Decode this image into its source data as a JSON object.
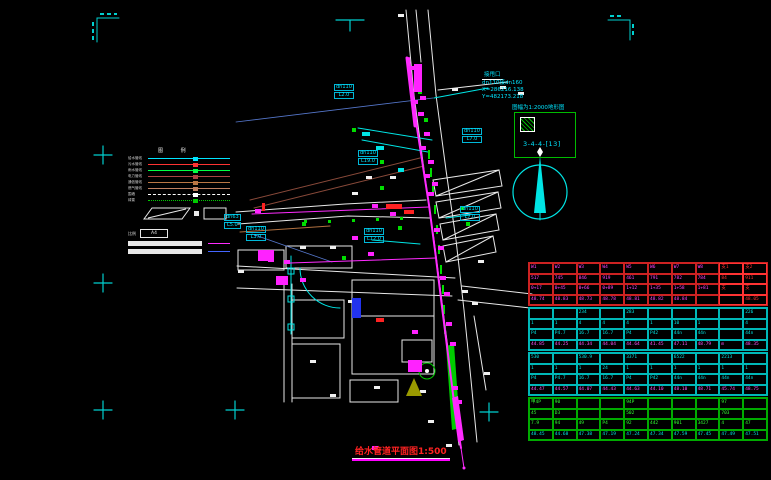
{
  "title": {
    "text": "给水管道平面图",
    "scale": "1:500"
  },
  "callout": {
    "note": "接甩口",
    "spec": "dn110接dn160",
    "coord_x": "X=286216.138",
    "coord_y": "Y=482173.218"
  },
  "detail": {
    "note": "图幅为1:2000地形图",
    "code": "3-4-4-[13]"
  },
  "north_arrow": "north-compass",
  "legend": {
    "header": "图 例",
    "items": [
      {
        "label": "给水管线",
        "color": "#00e5ff",
        "style": "solid"
      },
      {
        "label": "污水管线",
        "color": "#ff3333",
        "style": "solid"
      },
      {
        "label": "雨水管线",
        "color": "#00ff44",
        "style": "solid"
      },
      {
        "label": "电力管线",
        "color": "#aa4444",
        "style": "solid"
      },
      {
        "label": "通信管线",
        "color": "#bb7744",
        "style": "solid"
      },
      {
        "label": "燃气管线",
        "color": "#c08060",
        "style": "solid"
      },
      {
        "label": "围墙",
        "color": "#ffffff",
        "style": "dashed"
      },
      {
        "label": "绿篱",
        "color": "#00cc00",
        "style": "dotted"
      }
    ],
    "scale_label": "比例",
    "box_text": "A4"
  },
  "map": {
    "pipe_labels": [
      {
        "size": "dn110",
        "len": "L2.0",
        "x": 334,
        "y": 84
      },
      {
        "size": "dn110",
        "len": "L19.0",
        "x": 358,
        "y": 150
      },
      {
        "size": "dn110",
        "len": "L7.0",
        "x": 462,
        "y": 128
      },
      {
        "size": "dn110",
        "len": "L7.0",
        "x": 460,
        "y": 206
      },
      {
        "size": "dn63",
        "len": "L5.0",
        "x": 224,
        "y": 214
      },
      {
        "size": "dn110",
        "len": "L3.0",
        "x": 246,
        "y": 226
      },
      {
        "size": "dn110",
        "len": "L12.0",
        "x": 364,
        "y": 228
      }
    ]
  },
  "table": {
    "red_color": "#ff3333",
    "groups": [
      {
        "border": "#cc2222",
        "red_from": 8,
        "rows": [
          {
            "color": "#ff44ff",
            "cells": [
              "W1",
              "W2",
              "W3",
              "W4",
              "W5",
              "W6",
              "W7",
              "W8",
              "支1",
              "支2"
            ]
          },
          {
            "color": "#ff44ff",
            "cells": [
              "517",
              "745",
              "846",
              "919",
              "461",
              "791",
              "782",
              "784",
              "84",
              "911"
            ]
          },
          {
            "color": "#ff44ff",
            "cells": [
              "0+17",
              "0+45",
              "0+66",
              "0+89",
              "1+12",
              "1+35",
              "1+58",
              "1+81",
              "支",
              "支"
            ]
          },
          {
            "color": "#ff44ff",
            "cells": [
              "48.74",
              "48.83",
              "48.73",
              "48.78",
              "48.81",
              "48.82",
              "48.84",
              "",
              "",
              "48.05"
            ]
          }
        ]
      },
      {
        "border": "#00b8b8",
        "rows": [
          {
            "color": "#00e5e5",
            "cells": [
              "",
              "",
              "234",
              "",
              "283",
              "",
              "",
              "",
              "",
              "226"
            ]
          },
          {
            "color": "#00e5e5",
            "cells": [
              "1",
              "1",
              "4",
              "4",
              "4",
              "1",
              "10",
              "1",
              "",
              "4"
            ]
          },
          {
            "color": "#00e5e5",
            "cells": [
              "P4",
              "P4.7",
              "16.7",
              "16.7",
              "P4",
              "P42",
              "44n",
              "44n",
              "",
              "44n"
            ]
          },
          {
            "color": "#ff55ff",
            "cells": [
              "44.85",
              "44.25",
              "44.34",
              "44.04",
              "44.64",
              "41.45",
              "47.11",
              "48.79",
              "m",
              "48.35"
            ]
          }
        ]
      },
      {
        "border": "#00b8b8",
        "rows": [
          {
            "color": "#00e5e5",
            "cells": [
              "530",
              "",
              "530.9",
              "",
              "3371",
              "",
              "6522",
              "",
              "2213",
              ""
            ]
          },
          {
            "color": "#00e5e5",
            "cells": [
              "1",
              "1",
              "1",
              "24",
              "1",
              "1",
              "1",
              "1",
              "1",
              "1"
            ]
          },
          {
            "color": "#00e5e5",
            "cells": [
              "P4",
              "P4.7",
              "16.7",
              "16.7",
              "P4",
              "P42",
              "44n",
              "44n",
              "44n",
              "44n"
            ]
          },
          {
            "color": "#ff55ff",
            "cells": [
              "44.47",
              "44.57",
              "44.07",
              "44.43",
              "44.63",
              "44.10",
              "48.10",
              "48.71",
              "45.74",
              "48.75"
            ]
          }
        ]
      },
      {
        "border": "#00aa00",
        "rows": [
          {
            "color": "#33ff33",
            "cells": [
              "甲4P",
              "90",
              "",
              "",
              "94P",
              "",
              "",
              "",
              "97",
              ""
            ]
          },
          {
            "color": "#33ff33",
            "cells": [
              "45",
              "D3",
              "",
              "",
              "502",
              "",
              "",
              "",
              "703",
              ""
            ]
          },
          {
            "color": "#33ff33",
            "cells": [
              "7.9",
              "94",
              "49",
              "P4",
              "92",
              "442",
              "901",
              "3427",
              "4",
              "47"
            ]
          },
          {
            "color": "#00e5e5",
            "cells": [
              "48.45",
              "44.68",
              "47.38",
              "47.19",
              "47.24",
              "47.34",
              "47.59",
              "47.45",
              "47.49",
              "47.51"
            ]
          }
        ]
      }
    ]
  }
}
